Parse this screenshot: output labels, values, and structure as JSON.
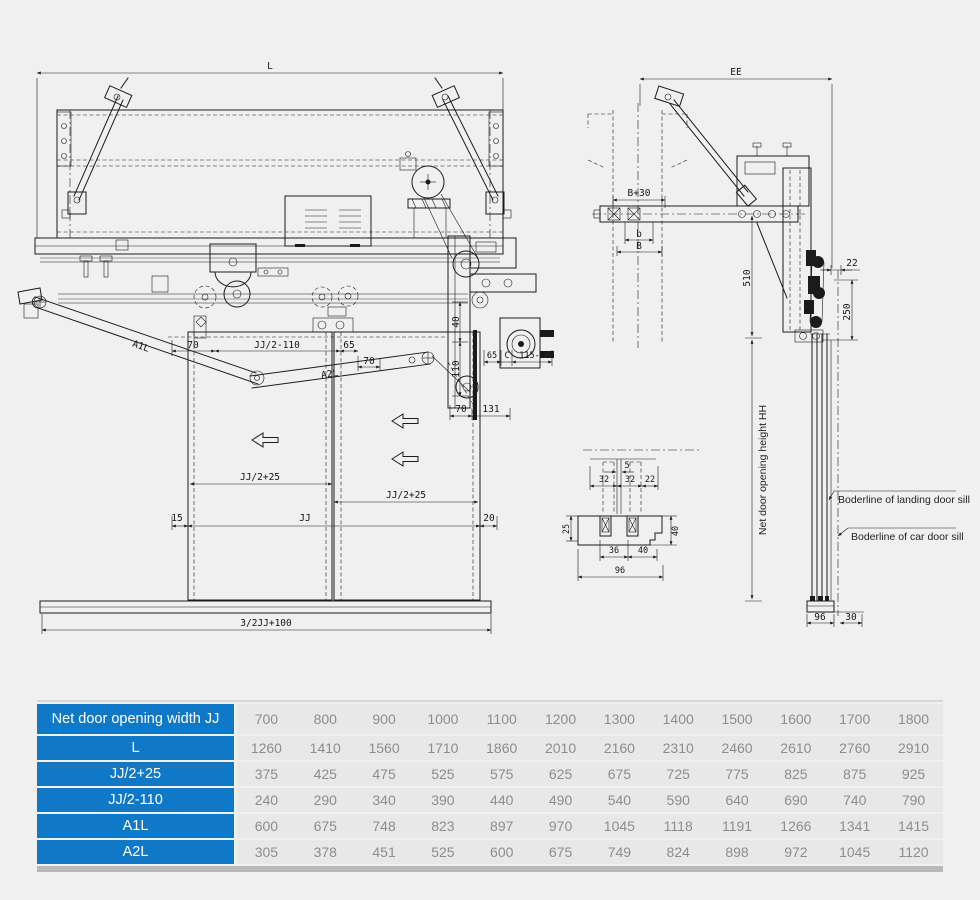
{
  "drawing": {
    "front_view": {
      "dim_l": "L",
      "dim_70_left": "70",
      "dim_jj2_minus110": "JJ/2-110",
      "dim_65_mid": "65",
      "dim_70_mid": "70",
      "arm1_label": "A1L",
      "arm2_label": "A2L",
      "dim_40_vert": "40",
      "dim_110_vert": "110",
      "dim_65_right": "65",
      "dim_c": "C",
      "dim_115e": "115-E",
      "dim_70_bottom": "70",
      "dim_131": "131",
      "dim_jj2_plus25_left": "JJ/2+25",
      "dim_jj2_plus25_right": "JJ/2+25",
      "dim_15": "15",
      "dim_jj": "JJ",
      "dim_20": "20",
      "dim_sill_width": "3/2JJ+100"
    },
    "side_view": {
      "dim_ee": "EE",
      "dim_b30": "B+30",
      "dim_b_lower": "b",
      "dim_b_upper": "B",
      "dim_510": "510",
      "dim_22": "22",
      "dim_250": "250",
      "dim_hh": "Net door opening height HH",
      "note_landing_sill": "Boderline of landing door sill",
      "note_car_sill": "Boderline of car door sill",
      "dim_96": "96",
      "dim_30": "30"
    },
    "sill_detail": {
      "dim_5": "5",
      "dim_32_left": "32",
      "dim_32_right": "32",
      "dim_22": "22",
      "dim_25": "25",
      "dim_40_side": "40",
      "dim_36": "36",
      "dim_40_bottom": "40",
      "dim_96": "96"
    }
  },
  "table": {
    "header_color": "#0f79c8",
    "rows": [
      {
        "label": "Net door opening width JJ",
        "values": [
          "700",
          "800",
          "900",
          "1000",
          "1100",
          "1200",
          "1300",
          "1400",
          "1500",
          "1600",
          "1700",
          "1800"
        ]
      },
      {
        "label": "L",
        "values": [
          "1260",
          "1410",
          "1560",
          "1710",
          "1860",
          "2010",
          "2160",
          "2310",
          "2460",
          "2610",
          "2760",
          "2910"
        ]
      },
      {
        "label": "JJ/2+25",
        "values": [
          "375",
          "425",
          "475",
          "525",
          "575",
          "625",
          "675",
          "725",
          "775",
          "825",
          "875",
          "925"
        ]
      },
      {
        "label": "JJ/2-110",
        "values": [
          "240",
          "290",
          "340",
          "390",
          "440",
          "490",
          "540",
          "590",
          "640",
          "690",
          "740",
          "790"
        ]
      },
      {
        "label": "A1L",
        "values": [
          "600",
          "675",
          "748",
          "823",
          "897",
          "970",
          "1045",
          "1118",
          "1191",
          "1266",
          "1341",
          "1415"
        ]
      },
      {
        "label": "A2L",
        "values": [
          "305",
          "378",
          "451",
          "525",
          "600",
          "675",
          "749",
          "824",
          "898",
          "972",
          "1045",
          "1120"
        ]
      }
    ]
  }
}
